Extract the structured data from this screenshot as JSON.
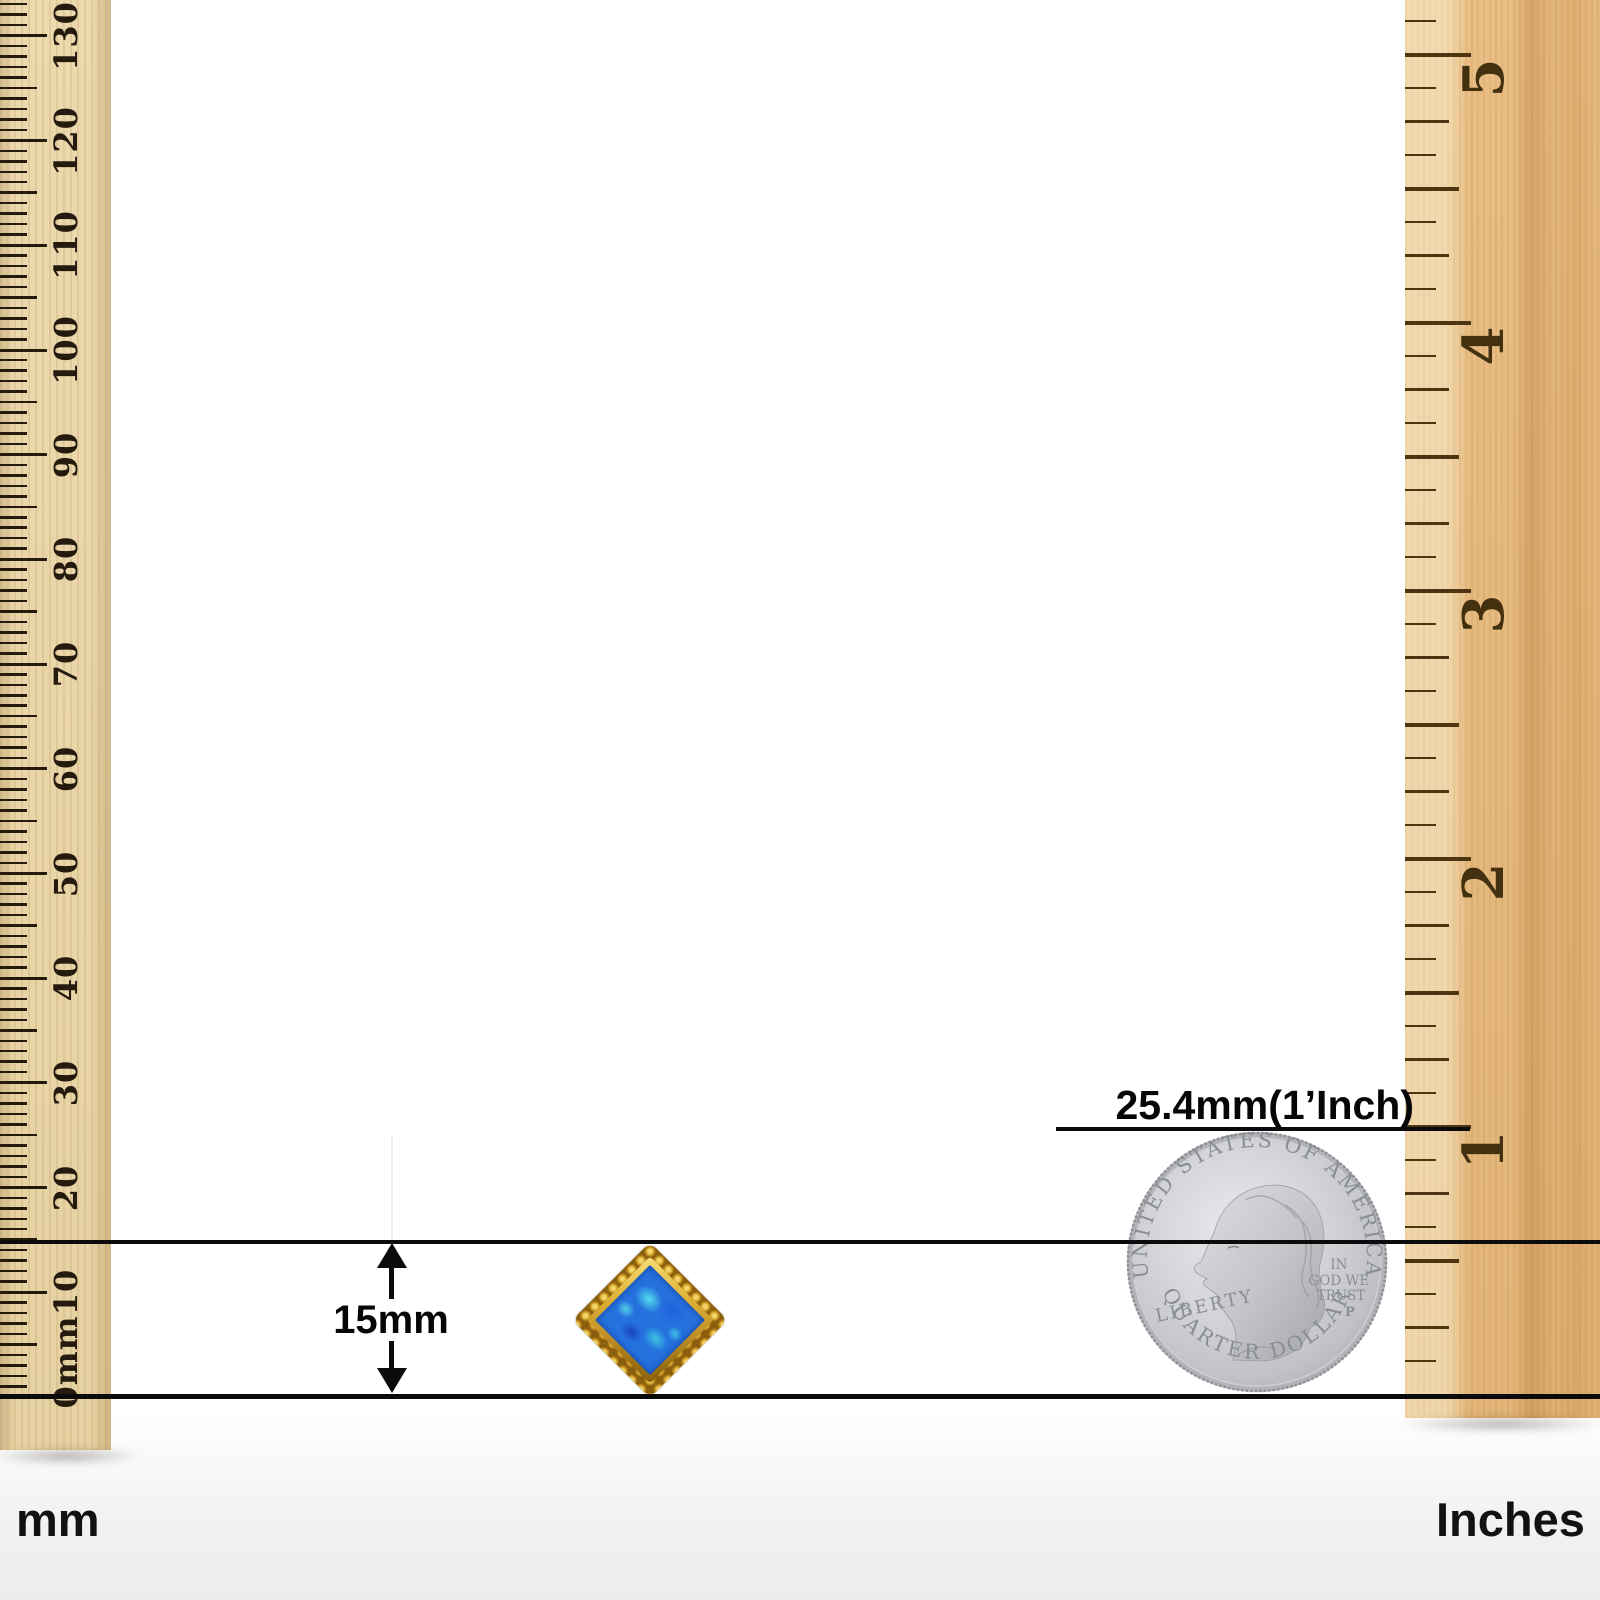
{
  "annotations": {
    "size_label": "15mm",
    "inch_label": "25.4mm(1’Inch)"
  },
  "left_ruler": {
    "unit_label": "mm",
    "zero_label": "0mm",
    "numbers": [
      "10",
      "20",
      "30",
      "40",
      "50",
      "60",
      "70",
      "80",
      "90",
      "100",
      "110",
      "120",
      "130"
    ]
  },
  "right_ruler": {
    "unit_label": "Inches",
    "numbers": [
      "1",
      "2",
      "3",
      "4",
      "5"
    ]
  },
  "coin": {
    "top_text": "UNITED STATES OF AMERICA",
    "bottom_text": "QUARTER DOLLAR",
    "left_text": "LIBERTY",
    "motto_lines": [
      "IN",
      "GOD WE",
      "TRUST"
    ],
    "mint_mark": "P"
  },
  "jewel": {
    "description": "gold diamond-shape stud with beaded frame and blue opal center",
    "gold_color": "#c9951d",
    "opal_blue": "#2571dd",
    "opal_cyan": "#3ed2e4"
  },
  "colors": {
    "line_black": "#0b0b0b",
    "left_wood": "#e9d5a7",
    "right_wood": "#e5ba80",
    "coin_silver": "#c6c8cc"
  }
}
